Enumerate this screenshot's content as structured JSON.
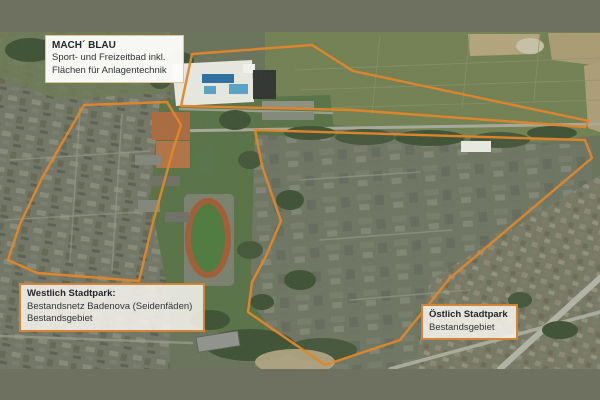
{
  "colors": {
    "outline_orange": "#e1862b",
    "letterbox_gray_green": "#6e7160",
    "label_border_orange": "#d08438",
    "label_background": "#f5f3ec",
    "label_text": "#24272c"
  },
  "labels": {
    "mach_blau": {
      "title": "MACH´ BLAU",
      "line1": "Sport- und Freizeitbad inkl.",
      "line2": "Flächen für Anlagentechnik"
    },
    "westlich": {
      "title": "Westlich Stadtpark:",
      "line1": "Bestandsnetz Badenova (Seidenfäden)",
      "line2": "Bestandsgebiet"
    },
    "oestlich": {
      "title": "Östlich Stadtpark",
      "line1": "Bestandsgebiet"
    }
  }
}
